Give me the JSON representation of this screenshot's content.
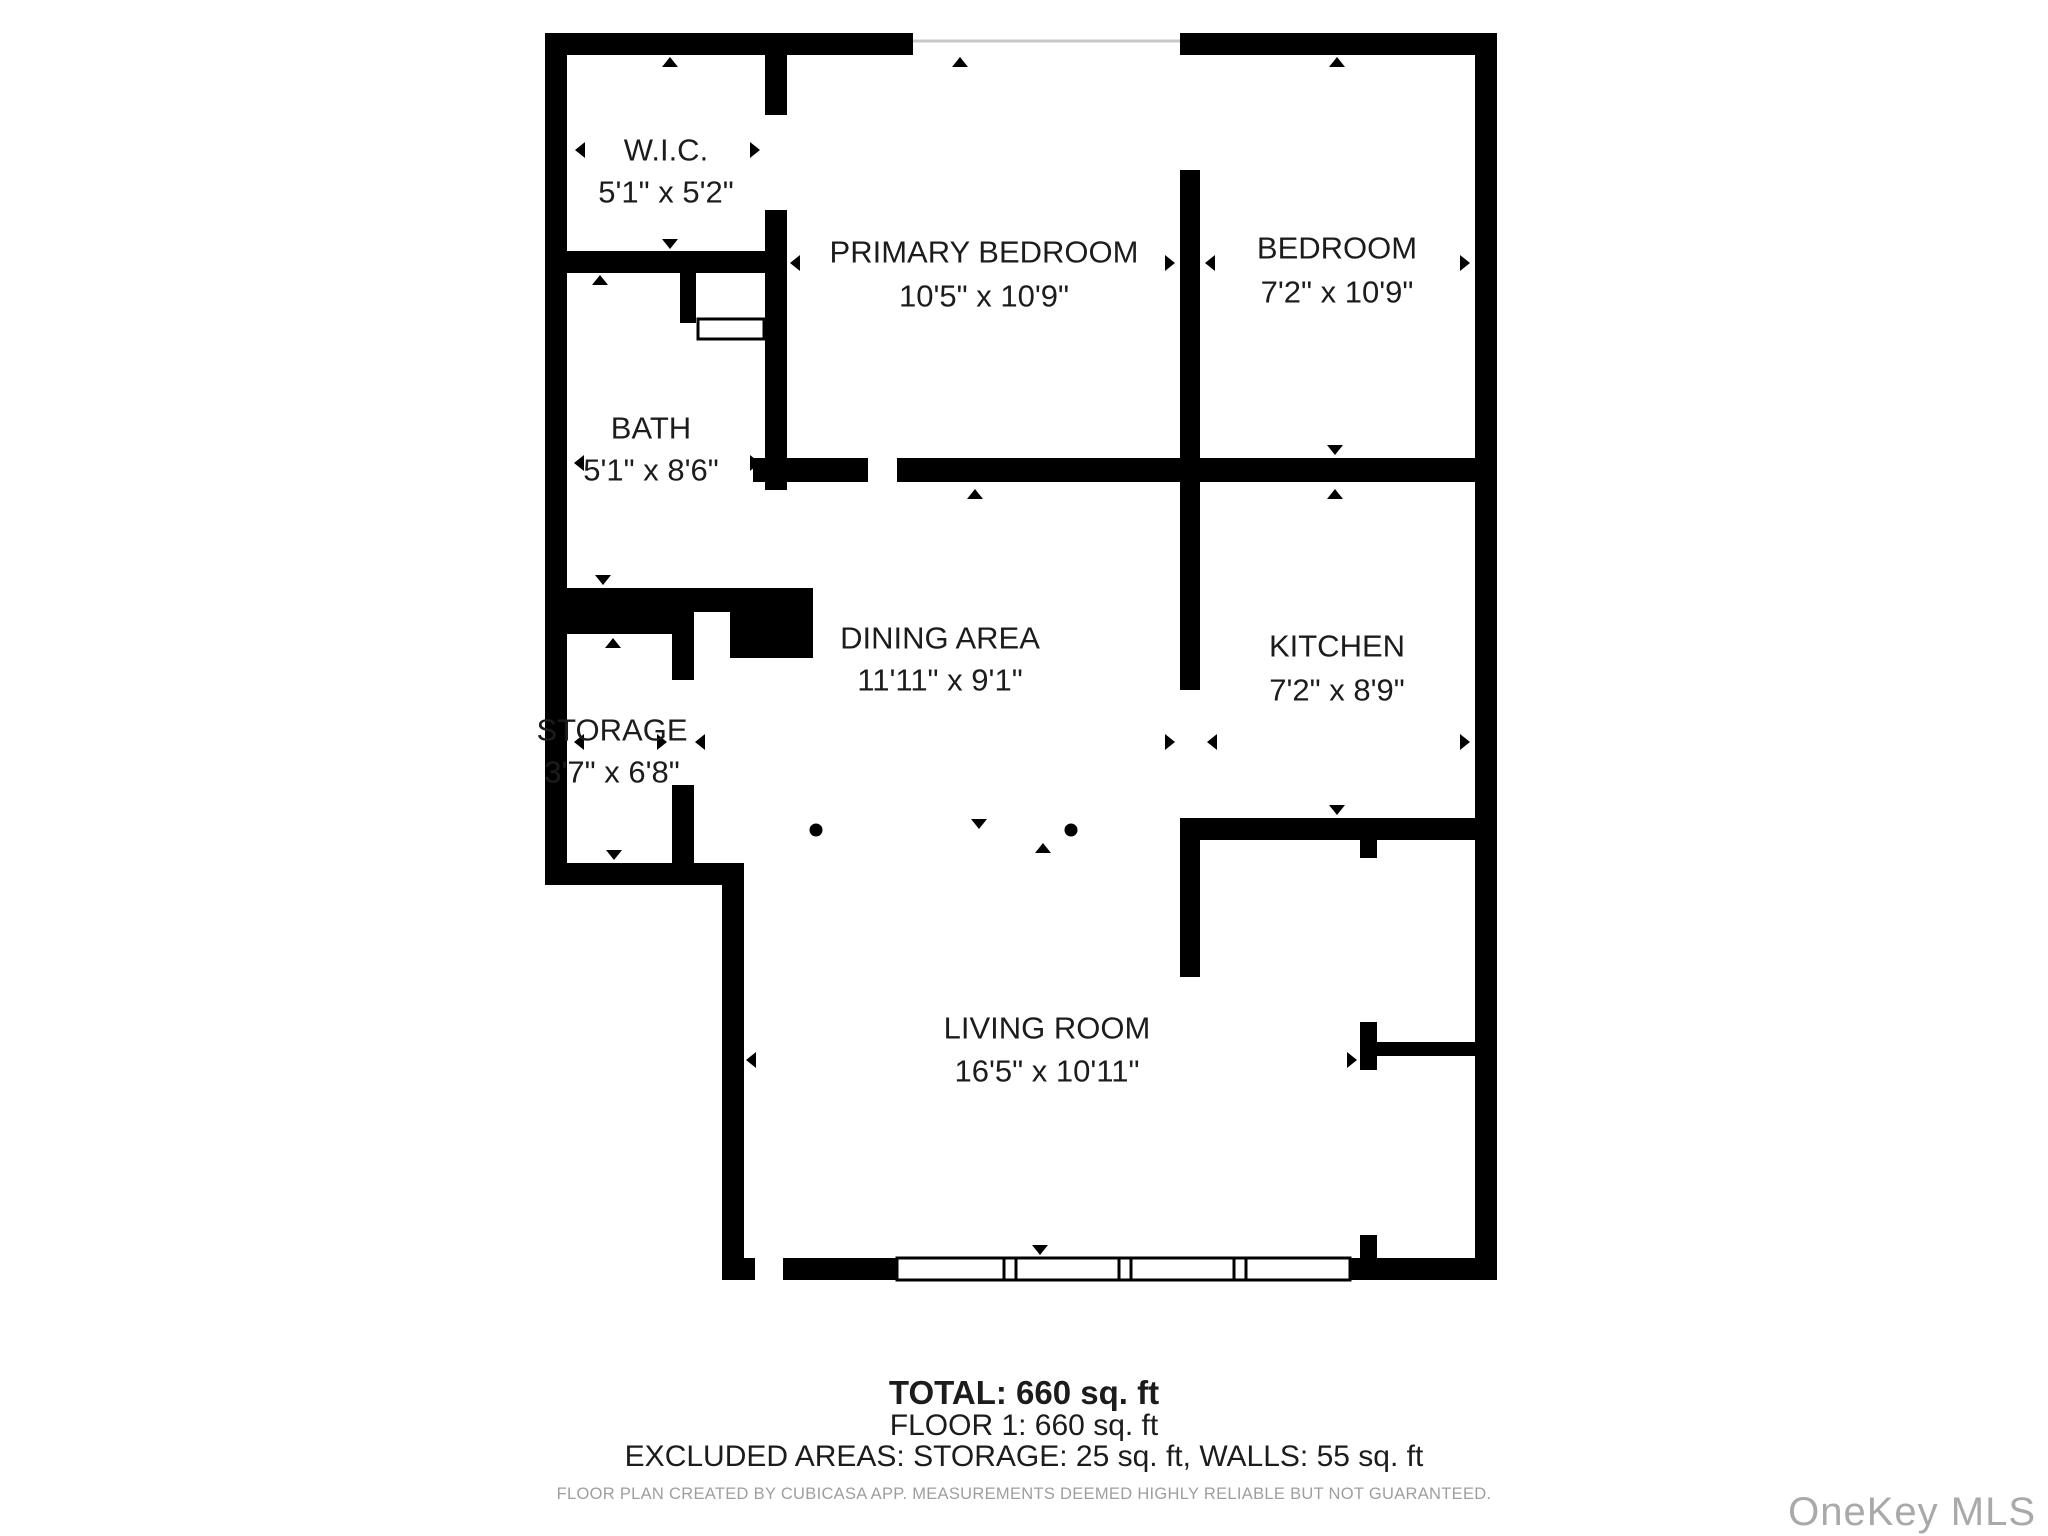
{
  "page": {
    "background": "#ffffff"
  },
  "floor_plan": {
    "wall_color": "#000000",
    "text_color": "#1c1c1c",
    "window_line_color": "#c8c8c8",
    "rooms": [
      {
        "id": "wic",
        "label": "W.I.C.",
        "dimensions": "5'1\" x 5'2\""
      },
      {
        "id": "primary_bedroom",
        "label": "PRIMARY BEDROOM",
        "dimensions": "10'5\" x 10'9\""
      },
      {
        "id": "bedroom",
        "label": "BEDROOM",
        "dimensions": "7'2\" x 10'9\""
      },
      {
        "id": "bath",
        "label": "BATH",
        "dimensions": "5'1\" x 8'6\""
      },
      {
        "id": "dining_area",
        "label": "DINING AREA",
        "dimensions": "11'11\" x 9'1\""
      },
      {
        "id": "kitchen",
        "label": "KITCHEN",
        "dimensions": "7'2\" x 8'9\""
      },
      {
        "id": "storage",
        "label": "STORAGE",
        "dimensions": "3'7\" x 6'8\""
      },
      {
        "id": "living_room",
        "label": "LIVING ROOM",
        "dimensions": "16'5\" x 10'11\""
      }
    ]
  },
  "summary": {
    "total": "TOTAL: 660 sq. ft",
    "floor": "FLOOR 1: 660 sq. ft",
    "excluded": "EXCLUDED AREAS: STORAGE: 25 sq. ft, WALLS: 55 sq. ft",
    "disclaimer": "FLOOR PLAN CREATED BY CUBICASA APP. MEASUREMENTS DEEMED HIGHLY RELIABLE BUT NOT GUARANTEED."
  },
  "watermark": {
    "text": "OneKey MLS",
    "color": "#a9a9a9"
  }
}
